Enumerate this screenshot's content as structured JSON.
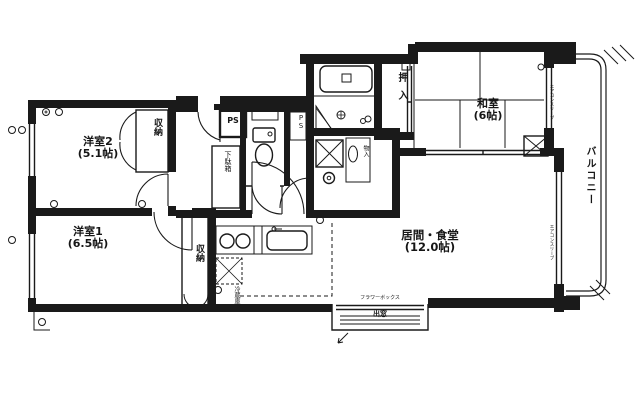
{
  "title": "間取り図",
  "colors": {
    "line": "#1a1a1a",
    "background": "#ffffff"
  },
  "rooms": [
    {
      "name": "洋室2",
      "size": "(5.1帖)"
    },
    {
      "name": "洋室1",
      "size": "(6.5帖)"
    },
    {
      "name": "和室",
      "size": "(6帖)"
    },
    {
      "name": "居間・食堂",
      "size": "(12.0帖)"
    }
  ],
  "labels": {
    "closet_top": "収納",
    "closet_left": "収納",
    "oshiire": "押入",
    "balcony": "バルコニー",
    "shoe_box": "下駄箱",
    "ps_top": "PS",
    "ps_mid": "PS",
    "fridge": "冷蔵庫",
    "mono_ire": "物入",
    "aircon_sleeve_1": "エアコンスリーブ",
    "aircon_sleeve_2": "エアコンスリーブ",
    "flower_box": "フラワーボックス",
    "bay_window": "出窓"
  },
  "icons": {
    "bathtub": "bathtub-symbol",
    "toilet": "toilet-symbol",
    "washer": "washing-machine-symbol",
    "stove": "gas-stove-symbol",
    "sink": "kitchen-sink-symbol",
    "hatch": "evacuation-hatch-symbol"
  }
}
